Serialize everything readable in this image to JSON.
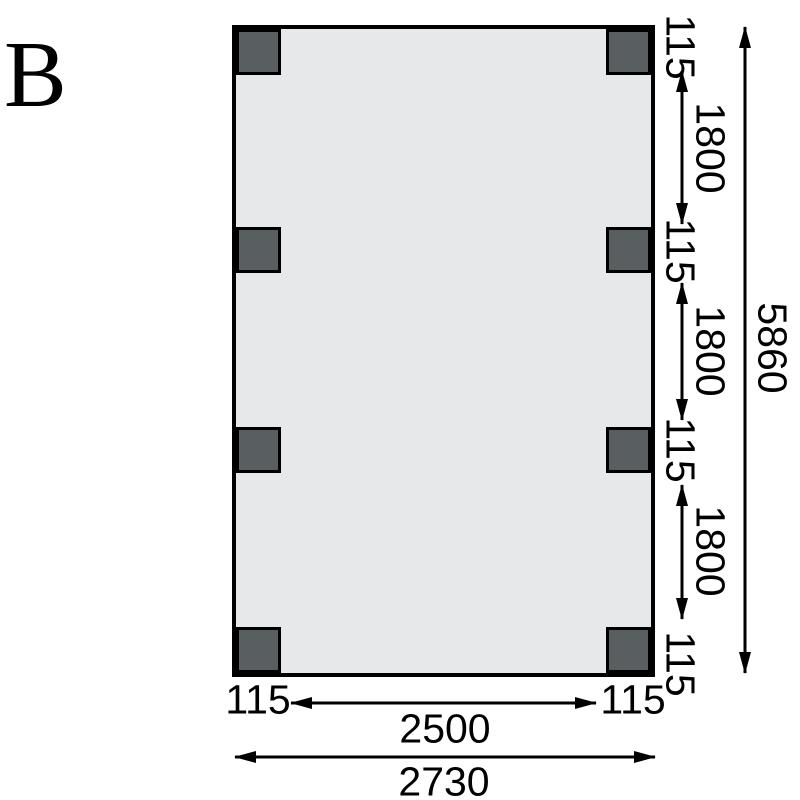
{
  "drawing": {
    "variant_label": "B",
    "type": "floor-plan-dimension-drawing",
    "colors": {
      "plan_fill": "#e7e8e9",
      "post_fill": "#595e61",
      "line": "#000000",
      "background": "#ffffff"
    },
    "posts": {
      "rows": 4,
      "columns": 2,
      "count": 8
    },
    "vertical_chain": {
      "segments": [
        "115",
        "1800",
        "115",
        "1800",
        "115",
        "1800",
        "115"
      ],
      "total": "5860"
    },
    "horizontal_chain": {
      "segments": [
        "115",
        "2500",
        "115"
      ],
      "total": "2730"
    }
  }
}
